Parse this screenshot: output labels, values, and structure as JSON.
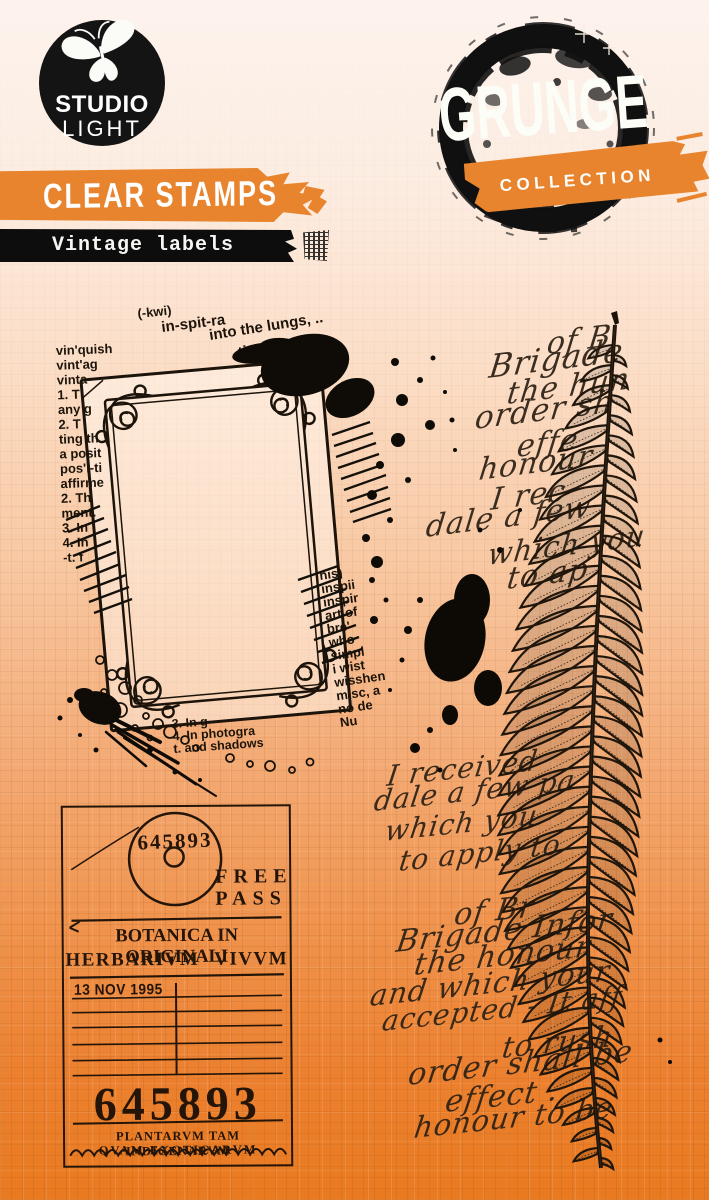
{
  "brand": {
    "studio": "STUDIO",
    "light": "LIGHT",
    "grunge": "GRUNGE",
    "collection": "COLLECTION"
  },
  "banners": {
    "clear_stamps": "CLEAR STAMPS",
    "subtitle": "Vintage labels"
  },
  "colors": {
    "background_top": "#fdf3ed",
    "background_bottom": "#e97a20",
    "accent_orange": "#e8842e",
    "ink_black": "#141414",
    "stamp_ink": "#1d140a"
  },
  "stamps": {
    "frame": {
      "newsprint_top": [
        "(-kwi)",
        "in-spit-ra",
        "into the lungs, ..",
        "-tion,"
      ],
      "newsprint_left": [
        "vin'quish",
        "vint'ag",
        "vinta",
        "1. T",
        "any g",
        "2. T",
        "ting th",
        "a posit",
        "pos'i-ti",
        "affirme",
        "2. Th",
        "ment.",
        "3. In",
        "4. In",
        "-t. f"
      ],
      "newsprint_right": [
        "nis)",
        "inspii",
        "inspir",
        "art of",
        "bre'",
        "who",
        "simpl",
        "i wist",
        "wisshen",
        "misc, a",
        "no de",
        "Nu"
      ],
      "newsprint_bottom": [
        "3. In g",
        "4. In photogra",
        "t. and shadows"
      ]
    },
    "ticket": {
      "serial_top": "645893",
      "free_line1": "FREE",
      "free_line2": "PASS",
      "title_line1": "BOTANICA IN ORIGINALI",
      "title_line2": "HERBARIVM VIVVM",
      "date": "13 NOV 1995",
      "serial_large": "645893",
      "footer_line1": "PLANTARVM TAM INDIGENARVM",
      "footer_line2": "QVAM EXOTICARVM"
    },
    "handwriting": {
      "lines": [
        "of B",
        "Brigade",
        "the hun",
        "order sh",
        "effe",
        "honour",
        "I rec",
        "dale a few",
        "which you",
        "to ap",
        "I received",
        "dale a few pa",
        "which you",
        "to apply to",
        "of Br",
        "Brigade Infor",
        "the honour",
        "and which your",
        "accepted - It aff",
        "to rush",
        "order shall be",
        "effect .",
        "honour to be"
      ]
    }
  }
}
